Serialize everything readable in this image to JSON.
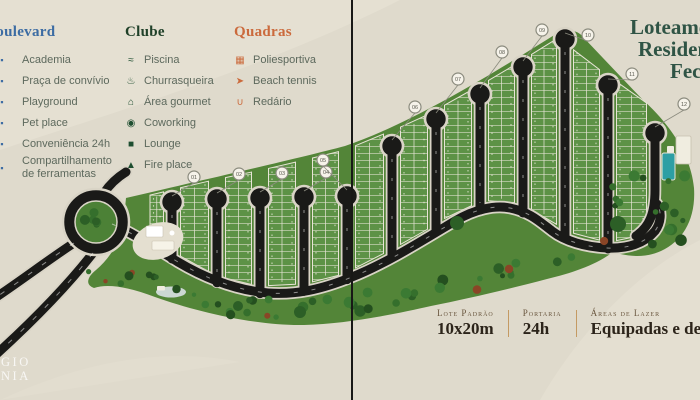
{
  "title": {
    "lines": [
      "Loteamento",
      "Residencial",
      "Fechado"
    ]
  },
  "legend": {
    "boulevard": {
      "title": "Boulevard",
      "items": [
        {
          "icon": "gym-icon",
          "glyph": "▪",
          "label": "Academia"
        },
        {
          "icon": "plaza-icon",
          "glyph": "▪",
          "label": "Praça de convívio"
        },
        {
          "icon": "playground-icon",
          "glyph": "▪",
          "label": "Playground"
        },
        {
          "icon": "pet-place-icon",
          "glyph": "▪",
          "label": "Pet place"
        },
        {
          "icon": "convenience-24h-icon",
          "glyph": "▪",
          "label": "Conveniência 24h"
        },
        {
          "icon": "tool-sharing-icon",
          "glyph": "▪",
          "label": "Compartilhamento de ferramentas"
        }
      ]
    },
    "clube": {
      "title": "Clube",
      "items": [
        {
          "icon": "pool-icon",
          "glyph": "≈",
          "label": "Piscina"
        },
        {
          "icon": "grill-icon",
          "glyph": "♨",
          "label": "Churrasqueira"
        },
        {
          "icon": "gourmet-area-icon",
          "glyph": "⌂",
          "label": "Área gourmet"
        },
        {
          "icon": "coworking-icon",
          "glyph": "◉",
          "label": "Coworking"
        },
        {
          "icon": "lounge-icon",
          "glyph": "■",
          "label": "Lounge"
        },
        {
          "icon": "fireplace-icon",
          "glyph": "▲",
          "label": "Fire place"
        }
      ]
    },
    "quadras": {
      "title": "Quadras",
      "items": [
        {
          "icon": "sports-court-icon",
          "glyph": "▦",
          "label": "Poliesportiva"
        },
        {
          "icon": "beach-tennis-icon",
          "glyph": "➤",
          "label": "Beach tennis"
        },
        {
          "icon": "hammock-icon",
          "glyph": "∪",
          "label": "Redário"
        }
      ]
    }
  },
  "info": {
    "items": [
      {
        "label": "Lote Padrão",
        "value": "10x20m"
      },
      {
        "label": "Portaria",
        "value": "24h"
      },
      {
        "label": "Áreas de Lazer",
        "value": "Equipadas e decoradas"
      }
    ]
  },
  "logo": {
    "lines": [
      "GIO",
      "NIA"
    ]
  },
  "map": {
    "streets": [
      {
        "x": 172,
        "top": 202,
        "marker": "01",
        "mdx": 22,
        "mdy": -25
      },
      {
        "x": 217,
        "top": 199,
        "marker": "02",
        "mdx": 22,
        "mdy": -25
      },
      {
        "x": 260,
        "top": 198,
        "marker": "03",
        "mdx": 22,
        "mdy": -25
      },
      {
        "x": 304,
        "top": 197,
        "marker": "04",
        "mdx": 22,
        "mdy": -25
      },
      {
        "x": 347,
        "top": 196,
        "marker": "05",
        "mdx": -24,
        "mdy": -36
      },
      {
        "x": 392,
        "top": 146,
        "marker": "06",
        "mdx": 23,
        "mdy": -39
      },
      {
        "x": 436,
        "top": 119,
        "marker": "07",
        "mdx": 22,
        "mdy": -40
      },
      {
        "x": 480,
        "top": 94,
        "marker": "08",
        "mdx": 22,
        "mdy": -42
      },
      {
        "x": 523,
        "top": 67,
        "marker": "09",
        "mdx": 19,
        "mdy": -37
      },
      {
        "x": 565,
        "top": 39,
        "marker": "10",
        "mdx": 23,
        "mdy": -4
      },
      {
        "x": 608,
        "top": 85,
        "marker": "11",
        "mdx": 24,
        "mdy": -11
      },
      {
        "x": 655,
        "top": 133,
        "marker": "12",
        "mdx": 29,
        "mdy": -29,
        "j": true
      }
    ]
  },
  "colors": {
    "background": "#dfdacc",
    "terrain_green": "#538538",
    "block_green": "#5d9246",
    "road_black": "#1a1a18",
    "road_casing": "#d9d4c6",
    "boulevard_blue": "#3c6ca3",
    "clube_green": "#1f4028",
    "quadras_orange": "#cb6a3c",
    "title_green": "#2f5445",
    "pool_teal": "#2d9fa4",
    "info_divider": "#c49a63",
    "tree_dark": "#2c5f26",
    "tree_accent": "#8a4526"
  }
}
